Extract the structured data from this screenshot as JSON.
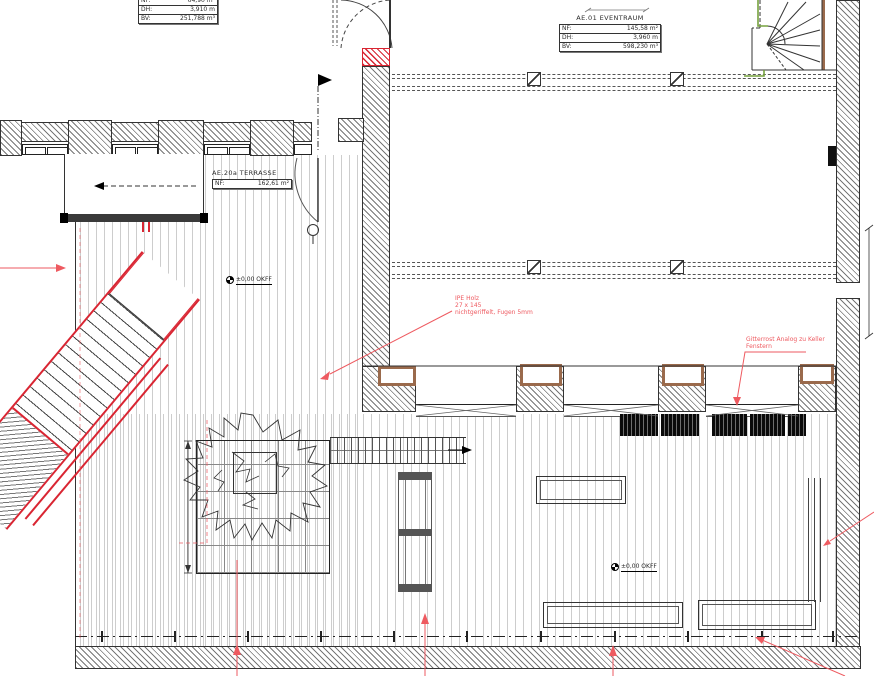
{
  "drawing": {
    "type": "architectural-floor-plan"
  },
  "rooms": {
    "upper_left": {
      "rows": [
        {
          "label": "NF:",
          "value": "64,90 m²"
        },
        {
          "label": "DH:",
          "value": "3,910 m"
        },
        {
          "label": "BV:",
          "value": "251,788 m³"
        }
      ]
    },
    "eventraum": {
      "title": "AE.01 EVENTRAUM",
      "rows": [
        {
          "label": "NF:",
          "value": "145,58 m²"
        },
        {
          "label": "DH:",
          "value": "3,960 m"
        },
        {
          "label": "BV:",
          "value": "598,230 m³"
        }
      ]
    },
    "terrasse": {
      "title": "AE.20a TERRASSE",
      "rows": [
        {
          "label": "NF:",
          "value": "162,61 m²"
        }
      ]
    }
  },
  "annotations": {
    "ipe": {
      "line1": "IPE Holz",
      "line2": "27 x 145",
      "line3": "nichtgeriffelt, Fugen 5mm"
    },
    "gitterrost": {
      "line1": "Gitterrost Analog zu Keller",
      "line2": "Fenstern"
    },
    "level_terrace": "±0,00 OKFF",
    "level_lower": "±0,00 OKFF"
  },
  "colors": {
    "red": "#d92532",
    "annotation_red": "#ee5a60",
    "green": "#76a23e",
    "brown": "#9a6a4c"
  }
}
